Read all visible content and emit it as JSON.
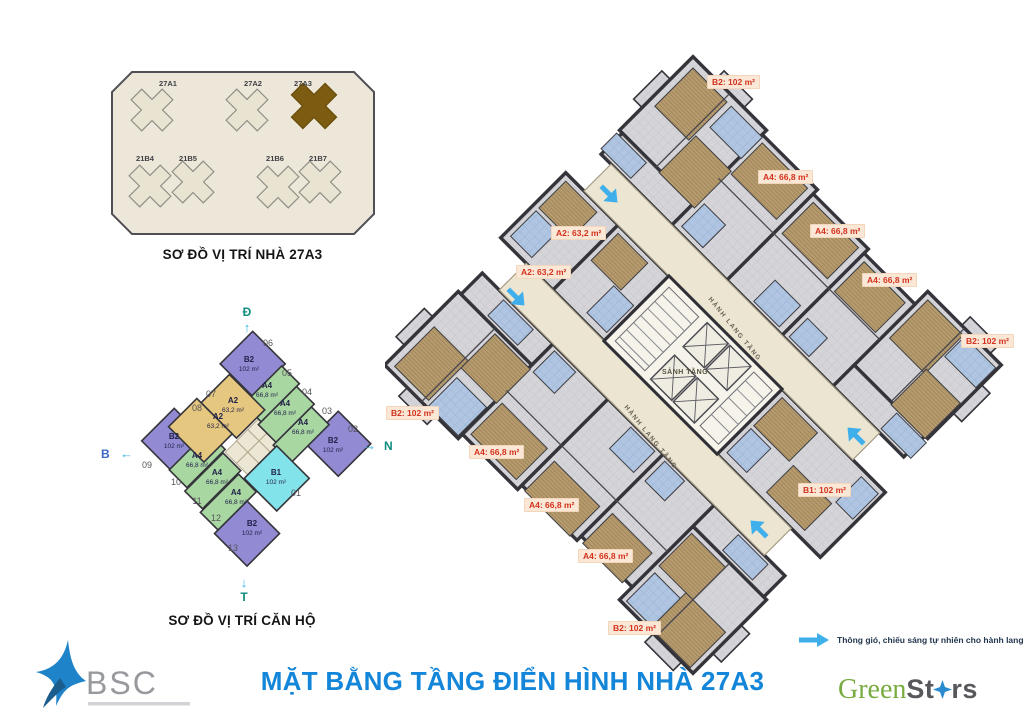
{
  "colors": {
    "accent_blue": "#1486d9",
    "label_red": "#d2321e",
    "arrow_cyan": "#3fafec",
    "b2_purple": "#928ad3",
    "a4_green": "#a9d7a2",
    "a2_tan": "#e6c77f",
    "b1_cyan": "#83e3ea",
    "highlight_olive": "#7b5c11"
  },
  "site_plan": {
    "caption": "SƠ ĐỒ VỊ TRÍ NHÀ 27A3",
    "highlighted": "27A3",
    "buildings": [
      {
        "name": "27A1"
      },
      {
        "name": "27A2"
      },
      {
        "name": "27A3"
      },
      {
        "name": "21B4"
      },
      {
        "name": "21B5"
      },
      {
        "name": "21B6"
      },
      {
        "name": "21B7"
      }
    ]
  },
  "unit_diagram": {
    "caption": "SƠ ĐỒ VỊ TRÍ CĂN HỘ",
    "compass": {
      "top": "Đ",
      "right": "N",
      "bottom": "T",
      "left": "B"
    },
    "units": [
      {
        "no": "06",
        "type": "B2",
        "area": "102 m²"
      },
      {
        "no": "05",
        "type": "A4",
        "area": "66,8 m²"
      },
      {
        "no": "04",
        "type": "A4",
        "area": "66,8 m²"
      },
      {
        "no": "03",
        "type": "A4",
        "area": "66,8 m²"
      },
      {
        "no": "02",
        "type": "B2",
        "area": "102 m²"
      },
      {
        "no": "07",
        "type": "A2",
        "area": "63,2 m²"
      },
      {
        "no": "08",
        "type": "A2",
        "area": "63,2 m²"
      },
      {
        "no": "09",
        "type": "B2",
        "area": "102 m²"
      },
      {
        "no": "10",
        "type": "A4",
        "area": "66,8 m²"
      },
      {
        "no": "11",
        "type": "A4",
        "area": "66,8 m²"
      },
      {
        "no": "12",
        "type": "A4",
        "area": "66,8 m²"
      },
      {
        "no": "13",
        "type": "B2",
        "area": "102 m²"
      },
      {
        "no": "01",
        "type": "B1",
        "area": "102 m²"
      }
    ]
  },
  "floor_plan": {
    "lobby_label": "SẢNH TẦNG",
    "corridor_label": "HÀNH LANG TẦNG",
    "labels": [
      "B2: 102 m²",
      "A4: 66,8 m²",
      "A4: 66,8 m²",
      "A4: 66,8 m²",
      "B2: 102 m²",
      "B1: 102 m²",
      "B2: 102 m²",
      "A4: 66,8 m²",
      "A4: 66,8 m²",
      "A4: 66,8 m²",
      "B2: 102 m²",
      "A2: 63,2 m²",
      "A2: 63,2 m²"
    ]
  },
  "legend": {
    "text": "Thông gió, chiếu sáng tự nhiên cho hành lang, cầu thang"
  },
  "title": "MẶT BẰNG TẦNG ĐIỂN HÌNH NHÀ 27A3",
  "logos": {
    "bsc_text": "BSC",
    "green": "Green",
    "stars_st": "St",
    "stars_rs": "rs"
  }
}
